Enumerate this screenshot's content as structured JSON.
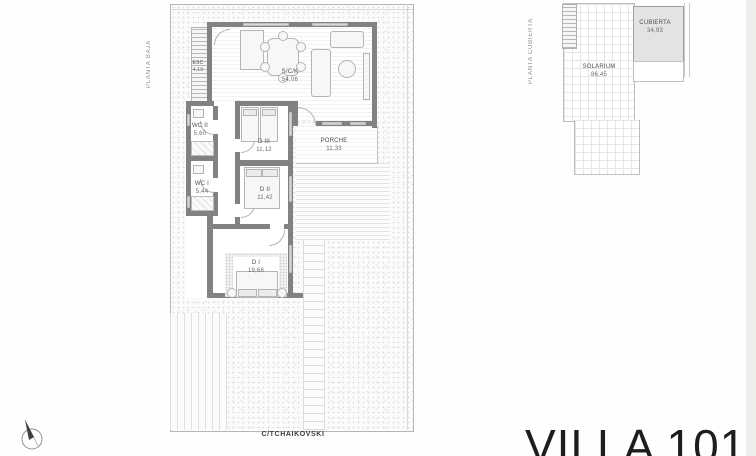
{
  "title": "VILLA 101",
  "street": "C/TCHAIKOVSKI",
  "ground_floor": {
    "label": "PLANTA BAJA",
    "rooms": {
      "esc": {
        "name": "ESC",
        "area": "4,19"
      },
      "sck": {
        "name": "S/C/K",
        "area": "54,06"
      },
      "wc2": {
        "name": "WC II",
        "area": "5,60"
      },
      "wc1": {
        "name": "WC I",
        "area": "5,44"
      },
      "d3": {
        "name": "D III",
        "area": "11,12"
      },
      "d2": {
        "name": "D II",
        "area": "11,42"
      },
      "d1": {
        "name": "D I",
        "area": "19,68"
      },
      "porche": {
        "name": "PORCHE",
        "area": "11,33"
      }
    }
  },
  "roof_floor": {
    "label": "PLANTA CUBIERTA",
    "rooms": {
      "solarium": {
        "name": "SOLARIUM",
        "area": "86,45"
      },
      "cubierta": {
        "name": "CUBIERTA",
        "area": "34,93"
      }
    }
  },
  "icons": {
    "compass": "north-arrow-icon"
  },
  "colors": {
    "wall": "#828282",
    "window": "#d8d8d8",
    "cubierta_fill": "#e3e3e3",
    "text_dark": "#1d1d1d",
    "line": "#b6b6b6"
  }
}
